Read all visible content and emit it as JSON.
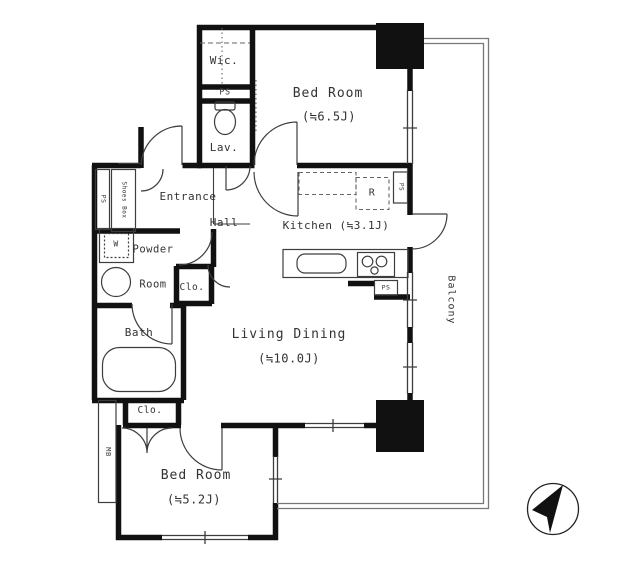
{
  "labels": {
    "wic": "Wic.",
    "ps_top": "PS",
    "lav": "Lav.",
    "bedroom1_name": "Bed Room",
    "bedroom1_size": "(≒6.5J)",
    "entrance": "Entrance",
    "hall": "Hall",
    "kitchen": "Kitchen (≒3.1J)",
    "refrigerator": "R",
    "ps_kitchen_wall": "PS",
    "ps_kitchen": "PS",
    "powder_line1": "Powder",
    "powder_line2": "Room",
    "washer": "W",
    "closet_hall": "Clo.",
    "bath": "Bath",
    "living_name": "Living Dining",
    "living_size": "(≒10.0J)",
    "closet_bedroom2": "Clo.",
    "meter_box": "MB",
    "bedroom2_name": "Bed Room",
    "bedroom2_size": "(≒5.2J)",
    "balcony": "Balcony",
    "shoes_box": "Shoes Box",
    "ps_entrance": "PS"
  },
  "colors": {
    "wall": "#111111",
    "thin_line": "#3d3d3d",
    "dashed_line": "#666666",
    "railing": "#777777",
    "text": "#333333",
    "background": "#ffffff"
  },
  "compass": {
    "needle_direction": "northeast"
  }
}
